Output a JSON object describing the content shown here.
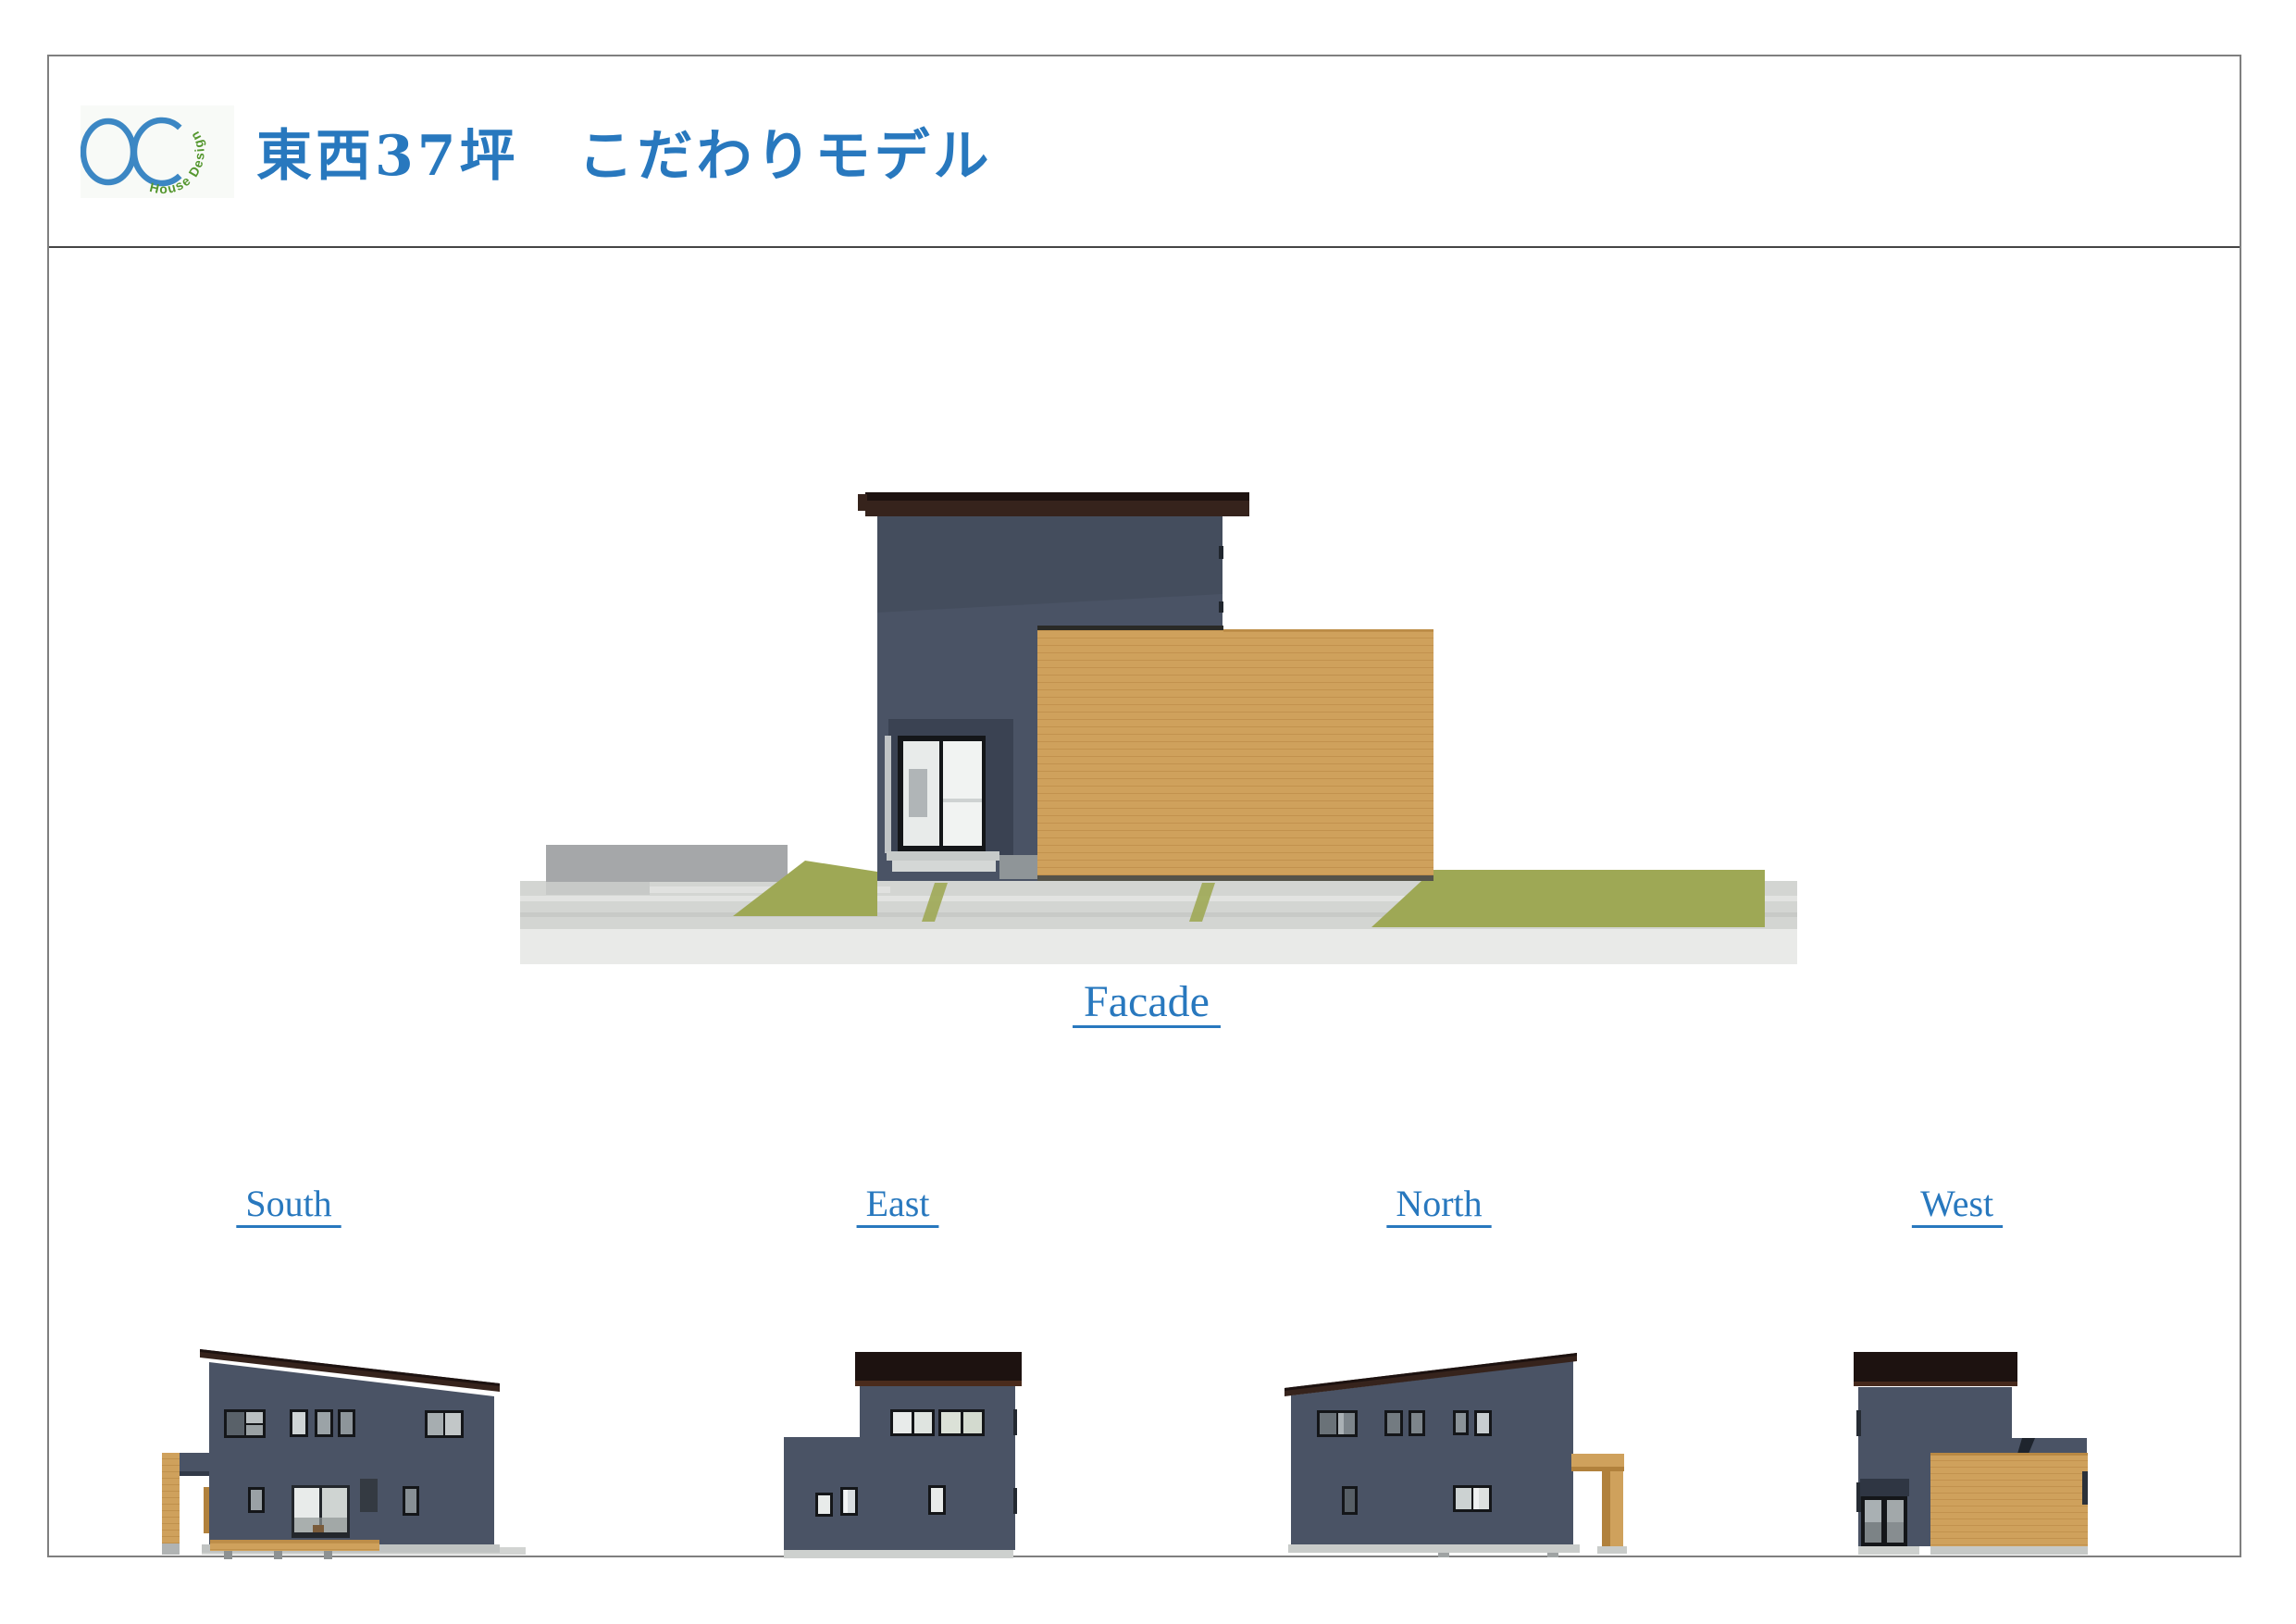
{
  "header": {
    "title": "東西37坪　こだわりモデル",
    "logo_arc_text": "House Design"
  },
  "captions": {
    "facade": " Facade ",
    "south": " South ",
    "east": " East ",
    "north": " North ",
    "west": " West "
  },
  "palette": {
    "blue": "#2878BE",
    "logo-blue": "#3C87C4",
    "logo-green": "#55972F",
    "border-gray": "#7F7F7F",
    "divider-gray": "#454545",
    "navy": "#4A5365",
    "navy-dark": "#3C4454",
    "roof-brown": "#36231C",
    "roof-dark": "#1D1210",
    "wood": "#CFA15C",
    "wood-dark": "#B1813C",
    "grass": "#9EA855",
    "pave": "#D3D5D2",
    "pave-light": "#E9EAE8",
    "wall-gray": "#A5A7A9",
    "base-gray": "#C0C3C2",
    "glass-light": "#E8EBEA",
    "glass-mid": "#A9B0B3",
    "glass-dark": "#6F777D",
    "frame-black": "#141619"
  }
}
